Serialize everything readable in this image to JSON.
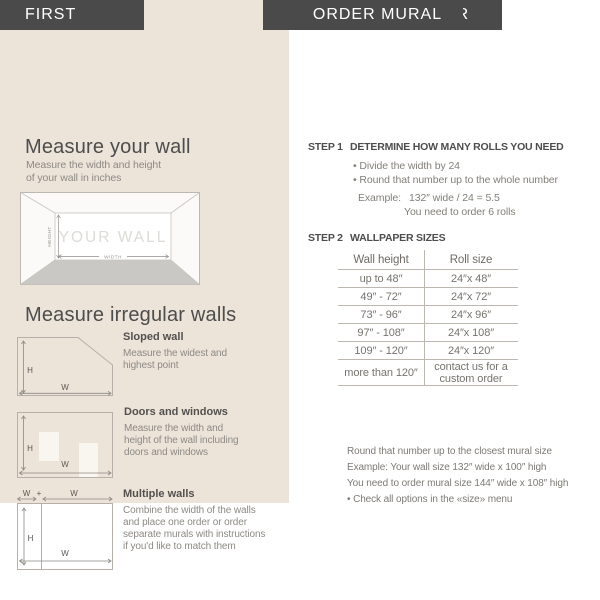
{
  "page_title": "ORDERING GUIDE",
  "colors": {
    "accent_dark": "#4a4a4a",
    "panel_beige": "#ece3d9"
  },
  "first": {
    "header": "FIRST",
    "measure_wall": {
      "heading": "Measure your wall",
      "description": "Measure the width and height\nof your wall in inches"
    },
    "wall_diagram": {
      "wall_label": "YOUR WALL",
      "height_label": "HEIGHT",
      "width_label": "WIDTH"
    },
    "irregular": {
      "heading": "Measure irregular walls",
      "labels": {
        "h": "H",
        "w": "W",
        "plus": "+"
      },
      "items": [
        {
          "title": "Sloped wall",
          "description": "Measure the widest and\nhighest point"
        },
        {
          "title": "Doors and windows",
          "description": "Measure the width and\nheight of the wall including\ndoors and windows"
        },
        {
          "title": "Multiple walls",
          "description": "Combine the width of the walls\nand place one order or order\nseparate murals with instructions\nif you'd like to match them"
        }
      ]
    }
  },
  "order_wallpaper": {
    "header": "ORDER WALLPAPER",
    "step1": {
      "label": "STEP 1",
      "title": "DETERMINE HOW MANY ROLLS YOU NEED",
      "bullets": [
        "• Divide the width by 24",
        "• Round that number up to the whole number"
      ],
      "example_label": "Example:",
      "example_value": "132″ wide / 24 = 5.5",
      "example_note": "You need to order 6 rolls"
    },
    "step2": {
      "label": "STEP 2",
      "title": "WALLPAPER SIZES",
      "table": {
        "headers": [
          "Wall height",
          "Roll size"
        ],
        "rows": [
          [
            "up to 48″",
            "24″x 48″"
          ],
          [
            "49″ - 72″",
            "24″x 72″"
          ],
          [
            "73″ - 96″",
            "24″x 96″"
          ],
          [
            "97″ - 108″",
            "24″x 108″"
          ],
          [
            "109″ - 120″",
            "24″x 120″"
          ],
          [
            "more than 120″",
            "contact us for a custom order"
          ]
        ]
      }
    }
  },
  "order_mural": {
    "header": "ORDER MURAL",
    "lines": [
      "Round that number up to the closest mural size",
      "Example: Your wall size 132″ wide x 100″ high",
      "You need to order mural size 144″ wide x 108″ high",
      "• Check all options in the «size» menu"
    ]
  }
}
